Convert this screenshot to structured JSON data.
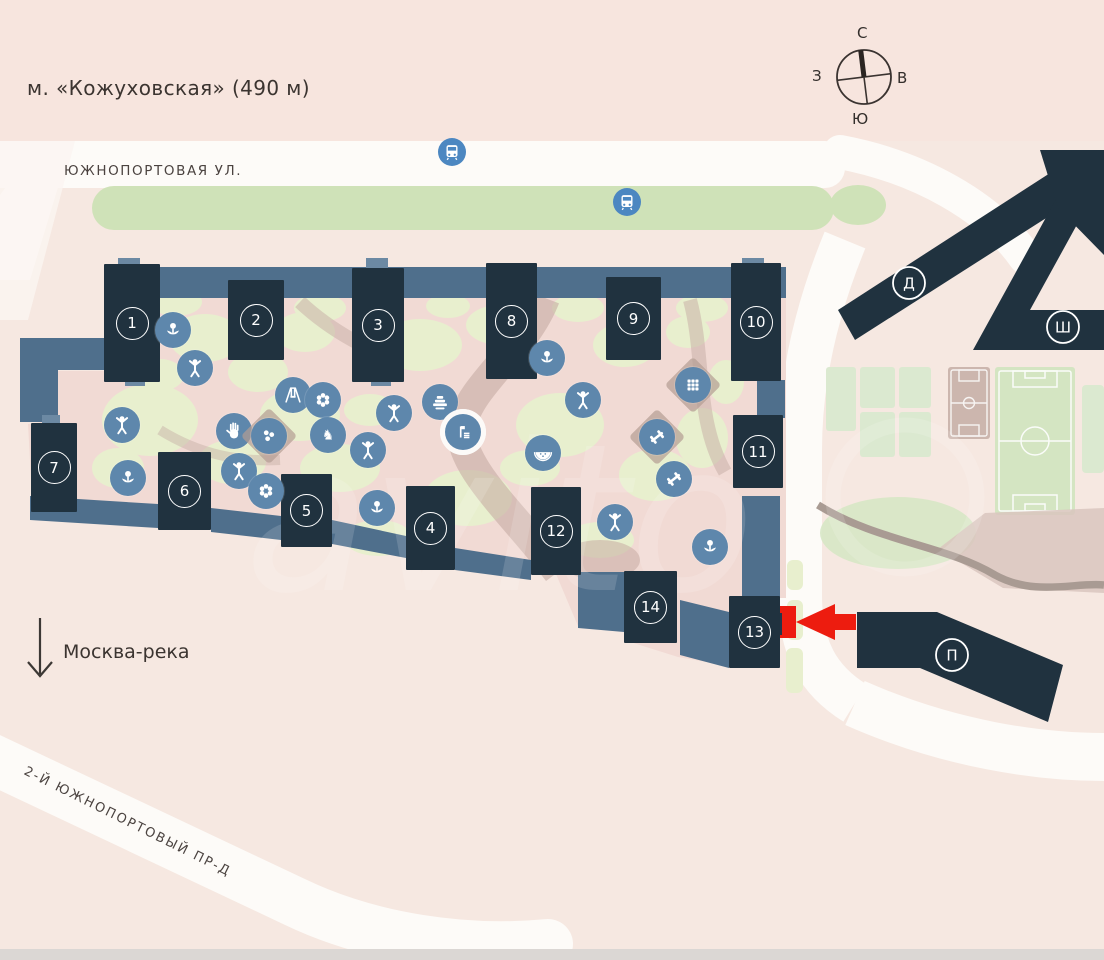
{
  "map": {
    "metro_label": "м. «Кожуховская» (490 м)",
    "street_top": "ЮЖНОПОРТОВАЯ УЛ.",
    "street_diagonal": "2-Й ЮЖНОПОРТОВЫЙ ПР-Д",
    "river_label": "Москва-река",
    "watermark_text": "аvito",
    "compass": {
      "north": "С",
      "south": "Ю",
      "west": "З",
      "east": "В"
    },
    "red_marker": {
      "points_to_building": "13"
    },
    "colors": {
      "background": "#f6e8e1",
      "building_navy": "#20323f",
      "connector_blue": "#4f6f8c",
      "icon_circle_blue": "#5e87ac",
      "bus_blue": "#4c87c1",
      "marker_red": "#ed1c0f",
      "green_strip": "#cfe2b8",
      "courtyard_pink": "#f1dad4",
      "courtyard_green": "#e8efce"
    },
    "buildings": [
      {
        "label": "1",
        "x": 104,
        "y": 264,
        "w": 56,
        "h": 118
      },
      {
        "label": "2",
        "x": 228,
        "y": 280,
        "w": 56,
        "h": 80
      },
      {
        "label": "3",
        "x": 352,
        "y": 268,
        "w": 52,
        "h": 114
      },
      {
        "label": "8",
        "x": 486,
        "y": 263,
        "w": 51,
        "h": 116
      },
      {
        "label": "9",
        "x": 606,
        "y": 277,
        "w": 55,
        "h": 83
      },
      {
        "label": "10",
        "x": 731,
        "y": 263,
        "w": 50,
        "h": 118
      },
      {
        "label": "11",
        "x": 733,
        "y": 415,
        "w": 50,
        "h": 73
      },
      {
        "label": "7",
        "x": 31,
        "y": 423,
        "w": 46,
        "h": 89
      },
      {
        "label": "6",
        "x": 158,
        "y": 452,
        "w": 53,
        "h": 78
      },
      {
        "label": "5",
        "x": 281,
        "y": 474,
        "w": 51,
        "h": 73
      },
      {
        "label": "4",
        "x": 406,
        "y": 486,
        "w": 49,
        "h": 84
      },
      {
        "label": "12",
        "x": 531,
        "y": 487,
        "w": 50,
        "h": 88
      },
      {
        "label": "14",
        "x": 624,
        "y": 571,
        "w": 53,
        "h": 72
      },
      {
        "label": "13",
        "x": 729,
        "y": 596,
        "w": 51,
        "h": 72
      }
    ],
    "letter_labels": [
      {
        "label": "Д",
        "x": 909,
        "y": 283
      },
      {
        "label": "Ш",
        "x": 1063,
        "y": 327
      },
      {
        "label": "П",
        "x": 952,
        "y": 655
      }
    ],
    "icons": [
      {
        "name": "flower-bed-icon",
        "glyph": "flower",
        "x": 173,
        "y": 330
      },
      {
        "name": "kids-playground-icon",
        "glyph": "person",
        "x": 195,
        "y": 368
      },
      {
        "name": "kids-playground-icon",
        "glyph": "person",
        "x": 122,
        "y": 425
      },
      {
        "name": "flower-bed-icon",
        "glyph": "flower",
        "x": 128,
        "y": 478
      },
      {
        "name": "swing-icon",
        "glyph": "swing",
        "x": 293,
        "y": 395
      },
      {
        "name": "flower-garden-icon",
        "glyph": "flower6",
        "x": 323,
        "y": 400
      },
      {
        "name": "sandbox-hand-icon",
        "glyph": "hand",
        "x": 234,
        "y": 431
      },
      {
        "name": "play-balls-icon",
        "glyph": "balls",
        "x": 269,
        "y": 436,
        "pad": true
      },
      {
        "name": "chess-icon",
        "glyph": "knight",
        "x": 328,
        "y": 435
      },
      {
        "name": "kids-playground-icon",
        "glyph": "person",
        "x": 394,
        "y": 413
      },
      {
        "name": "kids-playground-icon",
        "glyph": "person",
        "x": 368,
        "y": 450
      },
      {
        "name": "amphitheater-icon",
        "glyph": "tiers",
        "x": 440,
        "y": 402
      },
      {
        "name": "pool-icon",
        "glyph": "pool",
        "x": 463,
        "y": 432,
        "ring": true
      },
      {
        "name": "kids-playground-icon",
        "glyph": "person",
        "x": 239,
        "y": 471
      },
      {
        "name": "flower-garden-icon",
        "glyph": "flower6",
        "x": 266,
        "y": 491
      },
      {
        "name": "flower-bed-icon",
        "glyph": "flower",
        "x": 377,
        "y": 508
      },
      {
        "name": "flower-bed-icon",
        "glyph": "flower",
        "x": 547,
        "y": 358
      },
      {
        "name": "kids-playground-icon",
        "glyph": "person",
        "x": 583,
        "y": 400
      },
      {
        "name": "pavilion-icon",
        "glyph": "grid",
        "x": 693,
        "y": 385,
        "pad": true
      },
      {
        "name": "fitness-icon",
        "glyph": "dumbbell",
        "x": 657,
        "y": 437,
        "pad": true
      },
      {
        "name": "fitness-icon",
        "glyph": "dumbbell",
        "x": 674,
        "y": 479
      },
      {
        "name": "picnic-icon",
        "glyph": "watermelon",
        "x": 543,
        "y": 453
      },
      {
        "name": "kids-playground-icon",
        "glyph": "person",
        "x": 615,
        "y": 522
      },
      {
        "name": "flower-bed-icon",
        "glyph": "flower",
        "x": 710,
        "y": 547
      }
    ],
    "bus_stops": [
      {
        "x": 452,
        "y": 152
      },
      {
        "x": 627,
        "y": 202
      }
    ]
  }
}
